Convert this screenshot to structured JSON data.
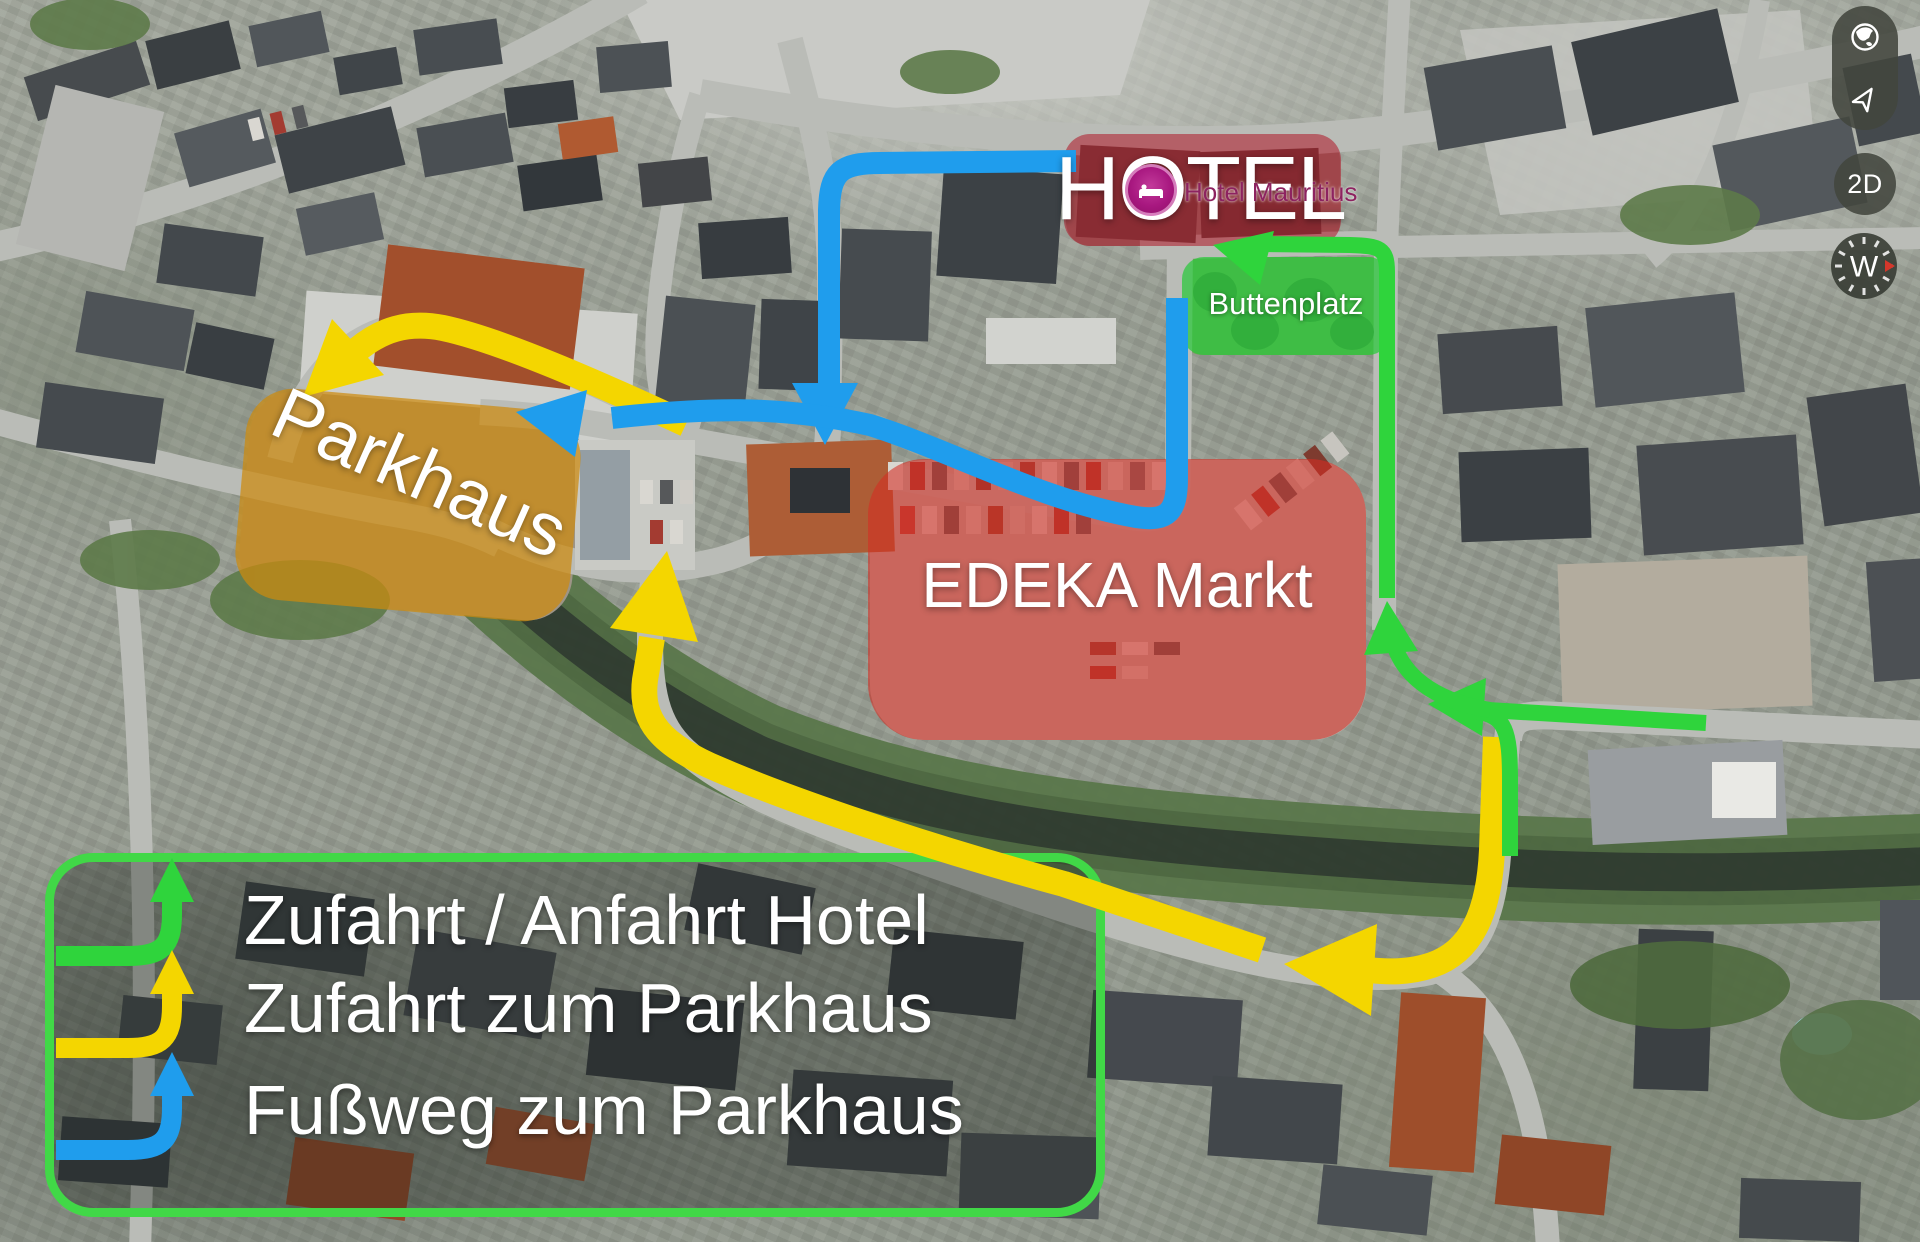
{
  "controls": {
    "view_mode": "2D",
    "compass_heading": "W"
  },
  "labels": {
    "hotel": "HOTEL",
    "hotel_place": "Hotel Mauritius",
    "buttenplatz": "Buttenplatz",
    "parkhaus": "Parkhaus",
    "edeka": "EDEKA Markt"
  },
  "legend": {
    "items": [
      {
        "label": "Zufahrt / Anfahrt Hotel",
        "color": "#2fd43c"
      },
      {
        "label": "Zufahrt zum Parkhaus",
        "color": "#f4d600"
      },
      {
        "label": "Fußweg zum Parkhaus",
        "color": "#1f9ded"
      }
    ],
    "border_color": "#41d847"
  },
  "routes": {
    "hotel_access": {
      "label": "Zufahrt / Anfahrt Hotel",
      "color": "#2fd43c"
    },
    "parkhaus_access": {
      "label": "Zufahrt zum Parkhaus",
      "color": "#f4d600"
    },
    "parkhaus_footpath": {
      "label": "Fußweg zum Parkhaus",
      "color": "#1f9ded"
    }
  },
  "overlays": {
    "hotel_fill": "#b01e2d",
    "edeka_fill": "#d62c22",
    "parkhaus_fill": "#cd8a0e",
    "buttenplatz_fill": "#2cc83e",
    "marker_fill": "#a81880"
  }
}
